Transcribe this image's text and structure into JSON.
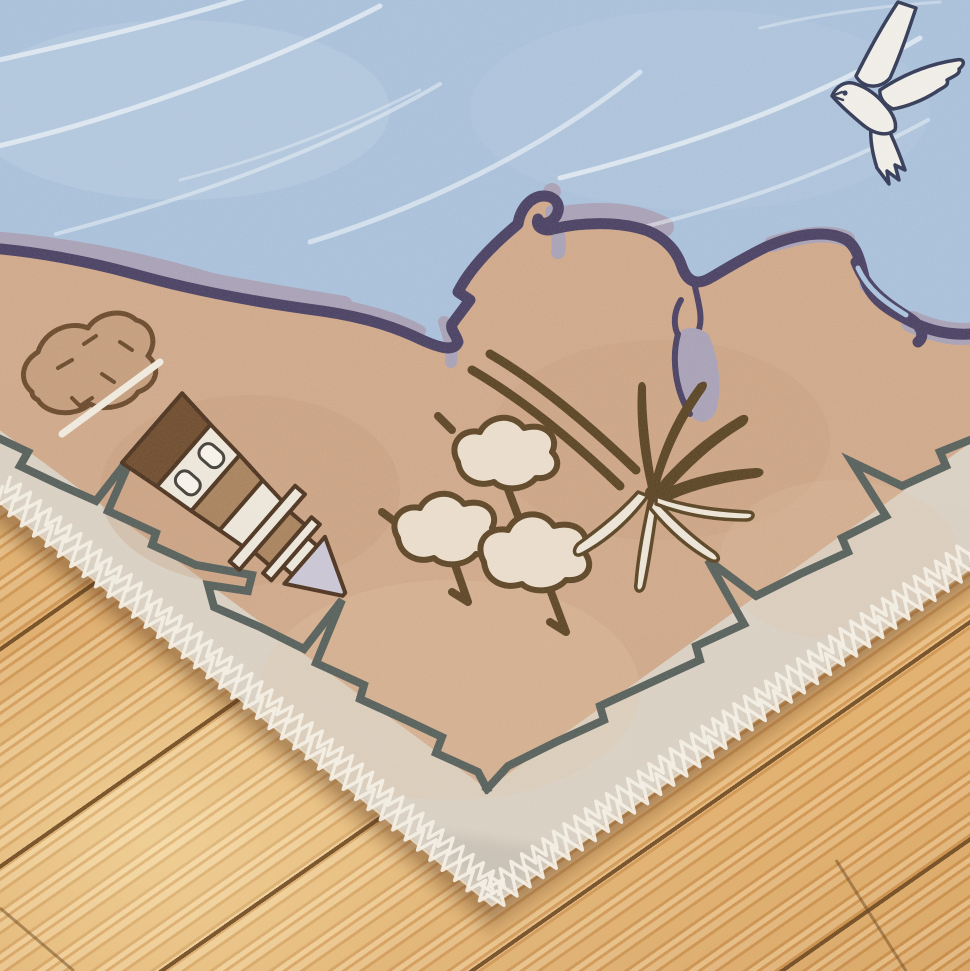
{
  "scene": {
    "alt": "Close-up photo of the corner of a children's seaside-map rug lying on diagonal pine floorboards",
    "floor": {
      "material": "pine floorboards",
      "layout": "diagonal planks with dark seams"
    },
    "rug": {
      "theme": "coastal map illustration",
      "motifs": [
        "light-blue sea with white wave lines",
        "white seagull with navy outline",
        "purple-outlined coastline with lavender shallows",
        "sketched boulder",
        "striped lighthouse with two windows and lavender cone roof",
        "three bushy cream trees",
        "palm tree with dark and cream fronds",
        "lagoon inlet with lavender teardrop",
        "jagged slate cliff line along the hem",
        "cream hem with white overlock zigzag stitching"
      ]
    }
  },
  "palette": {
    "water": "#a9c0da",
    "wave": "#eef3f8",
    "coast": "#4a4163",
    "coastShadow": "#a8a1b6",
    "lagoonBlue": "#aac2dc",
    "land": "#cfa88a",
    "landShade": "#c29878",
    "rockFill": "#c49d7c",
    "border": "#d9d0c3",
    "cliff": "#57605b",
    "stitch": "#f3eee4",
    "edgeLip": "#e7dfd1",
    "outlineDark": "#4d3420",
    "gullFill": "#f0ede7",
    "gullLine": "#333a56",
    "lhDark": "#6f4c2e",
    "lhMid": "#a8825d",
    "lhLight": "#ece6da",
    "roof": "#c9c5d4",
    "windowFill": "#f6f2e9",
    "windowLine": "#43403a",
    "canopy": "#e9dccb",
    "canopyLine": "#5e4526",
    "palmDark": "#5a4424",
    "frondLight": "#ece4d6",
    "woodBase": "#dcab6d",
    "woodGap": "#6f4b24",
    "rugShadow": "#583216"
  }
}
